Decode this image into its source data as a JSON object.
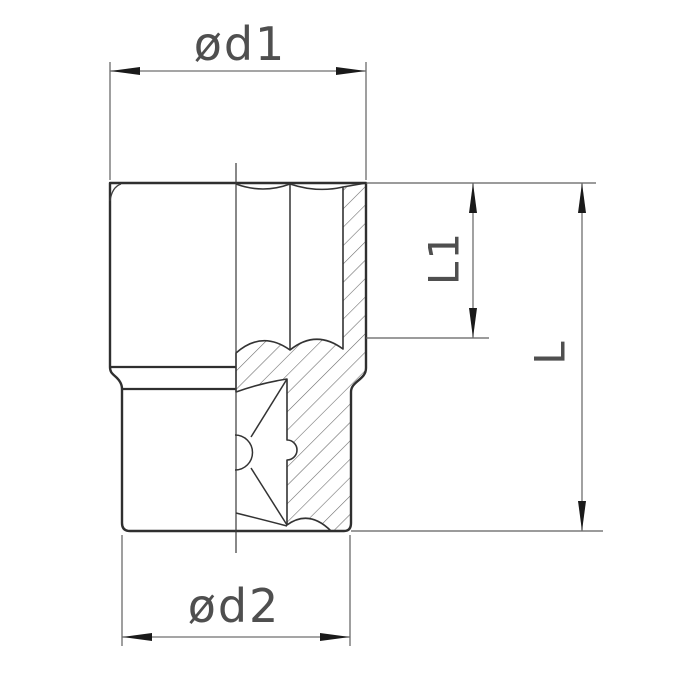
{
  "drawing": {
    "kind": "socket-wrench-socket-section-drawing",
    "dimensions": {
      "d1_label": "ød1",
      "d2_label": "ød2",
      "l1_label": "L1",
      "l_label": "L"
    },
    "colors": {
      "background": "#ffffff",
      "part_outline": "#2f2f2f",
      "section_hatch": "#6a6a6a",
      "dimension_lines": "#6f6f6f",
      "arrowheads": "#1a1a1a",
      "label_text": "#4f4f4f"
    }
  }
}
